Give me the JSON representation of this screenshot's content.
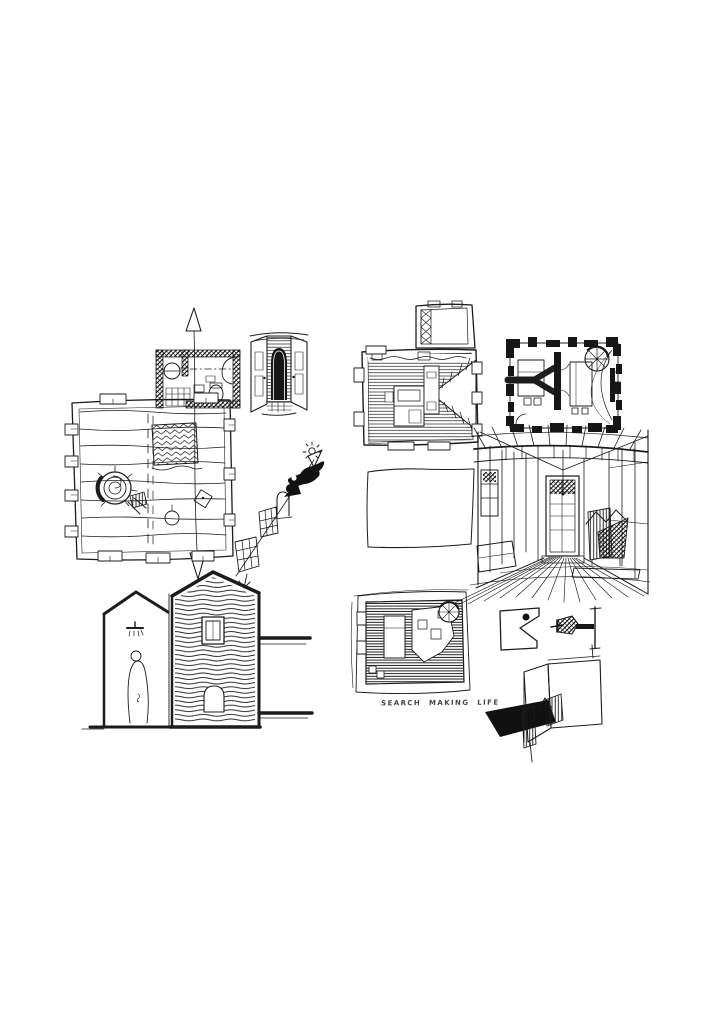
{
  "page": {
    "kind": "scanned sketchbook sheet of architectural ink drawings",
    "background_color": "#ffffff",
    "ink_color": "#1c1c1c"
  },
  "caption": {
    "text": "SEARCH MAKING LIFE"
  },
  "sketches": [
    {
      "id": "plan-upper-left",
      "description": "L-shaped floor plan with dark hatched bathroom wing, plank floor, round hearth/spiral, vertical section line with open arrows at both ends"
    },
    {
      "id": "doorway-vignette",
      "description": "Open double doors revealing a dark arched niche over small steps"
    },
    {
      "id": "diagonal-arrow-sequence",
      "description": "Diagonal arrow ascending past two gridded steps, an arched door, a solid arrowhead, a black gecko silhouette and a small sun"
    },
    {
      "id": "plan-upper-right",
      "description": "Plank-hatched plan with bed, white wedge stair notch on the right and small annex room above"
    },
    {
      "id": "plan-poche",
      "description": "Plan with heavy black crenellated poché walls, forked interior wall, spiral stair in corner and furniture"
    },
    {
      "id": "interior-perspective",
      "description": "One-point interior perspective: beamed ceiling, panelled walls, end door, dark chair, converging plank floor"
    },
    {
      "id": "empty-frame",
      "description": "Empty hand-drawn rectangular frame"
    },
    {
      "id": "section-two-gables",
      "description": "Cross-section of two gabled volumes: left with shower and standing figure, right hatched with window and arched niche; ground lines to the right"
    },
    {
      "id": "plan-bottom-middle",
      "description": "Densely hatched furnished plan with bed, table cluster and spiral stair; captioned below"
    },
    {
      "id": "diagram-equation",
      "description": "Notched square with black dot, plus sign, and black hatched flag attached to a vertical pole"
    },
    {
      "id": "axon-corner",
      "description": "Axonometric wall corner with hatched door leaves and a solid black cast shadow"
    }
  ]
}
